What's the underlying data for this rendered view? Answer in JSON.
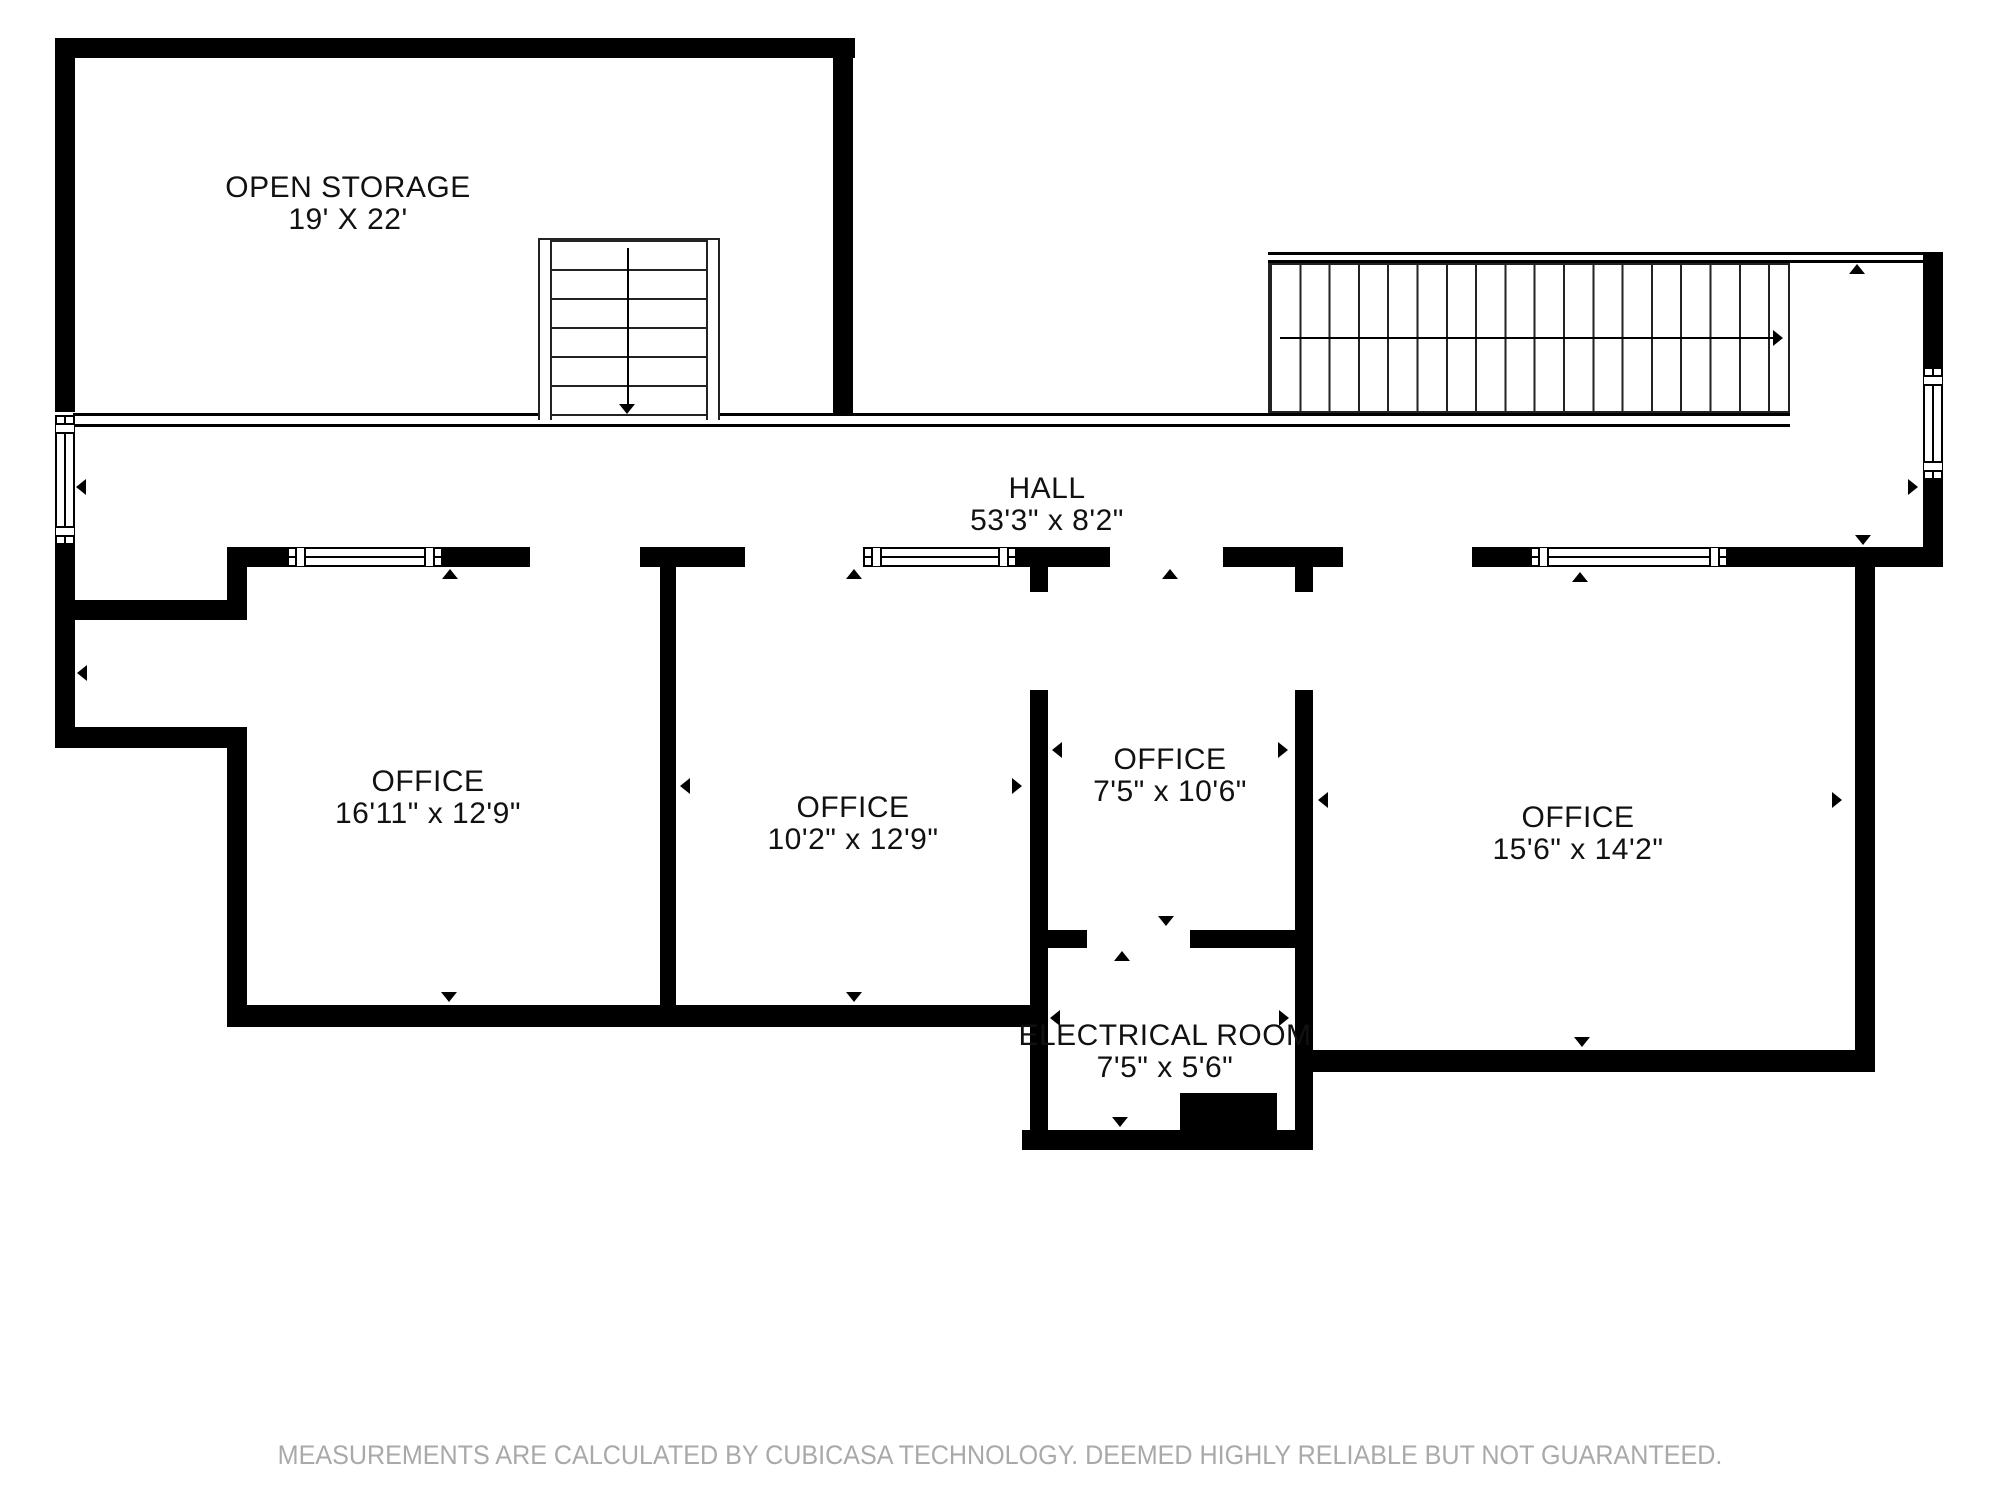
{
  "floorplan": {
    "rooms": {
      "open_storage": {
        "name": "OPEN STORAGE",
        "dims": "19' X 22'"
      },
      "hall": {
        "name": "HALL",
        "dims": "53'3\" x 8'2\""
      },
      "office_1": {
        "name": "OFFICE",
        "dims": "16'11\" x 12'9\""
      },
      "office_2": {
        "name": "OFFICE",
        "dims": "10'2\" x 12'9\""
      },
      "office_3": {
        "name": "OFFICE",
        "dims": "7'5\" x 10'6\""
      },
      "office_4": {
        "name": "OFFICE",
        "dims": "15'6\" x 14'2\""
      },
      "electrical_room": {
        "name": "ELECTRICAL ROOM",
        "dims": "7'5\" x 5'6\""
      }
    },
    "footer": "MEASUREMENTS ARE CALCULATED BY CUBICASA TECHNOLOGY. DEEMED HIGHLY RELIABLE BUT NOT GUARANTEED.",
    "colors": {
      "wall": "#000000",
      "background": "#ffffff",
      "footer_text": "#a9a9a9"
    }
  }
}
